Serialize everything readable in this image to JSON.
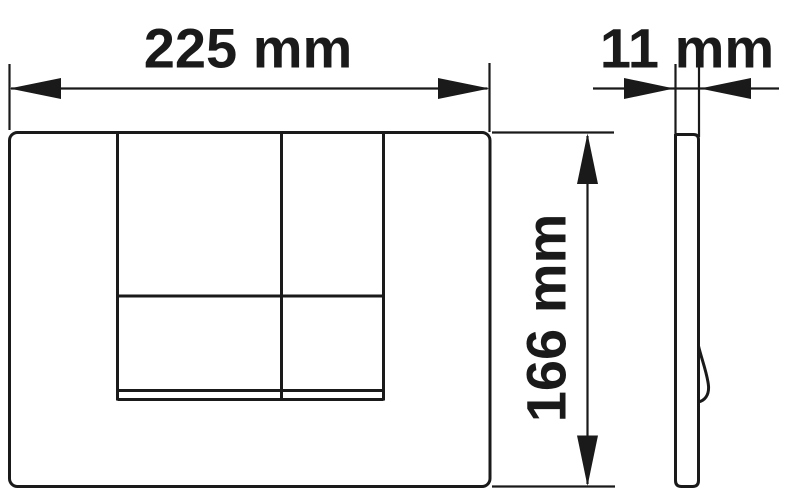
{
  "colors": {
    "ink": "#1a1a1a",
    "background": "#ffffff"
  },
  "dimensions": {
    "width": {
      "label": "225 mm",
      "value": 225,
      "unit": "mm"
    },
    "depth": {
      "label": "11 mm",
      "value": 11,
      "unit": "mm"
    },
    "height": {
      "label": "166 mm",
      "value": 166,
      "unit": "mm"
    }
  }
}
